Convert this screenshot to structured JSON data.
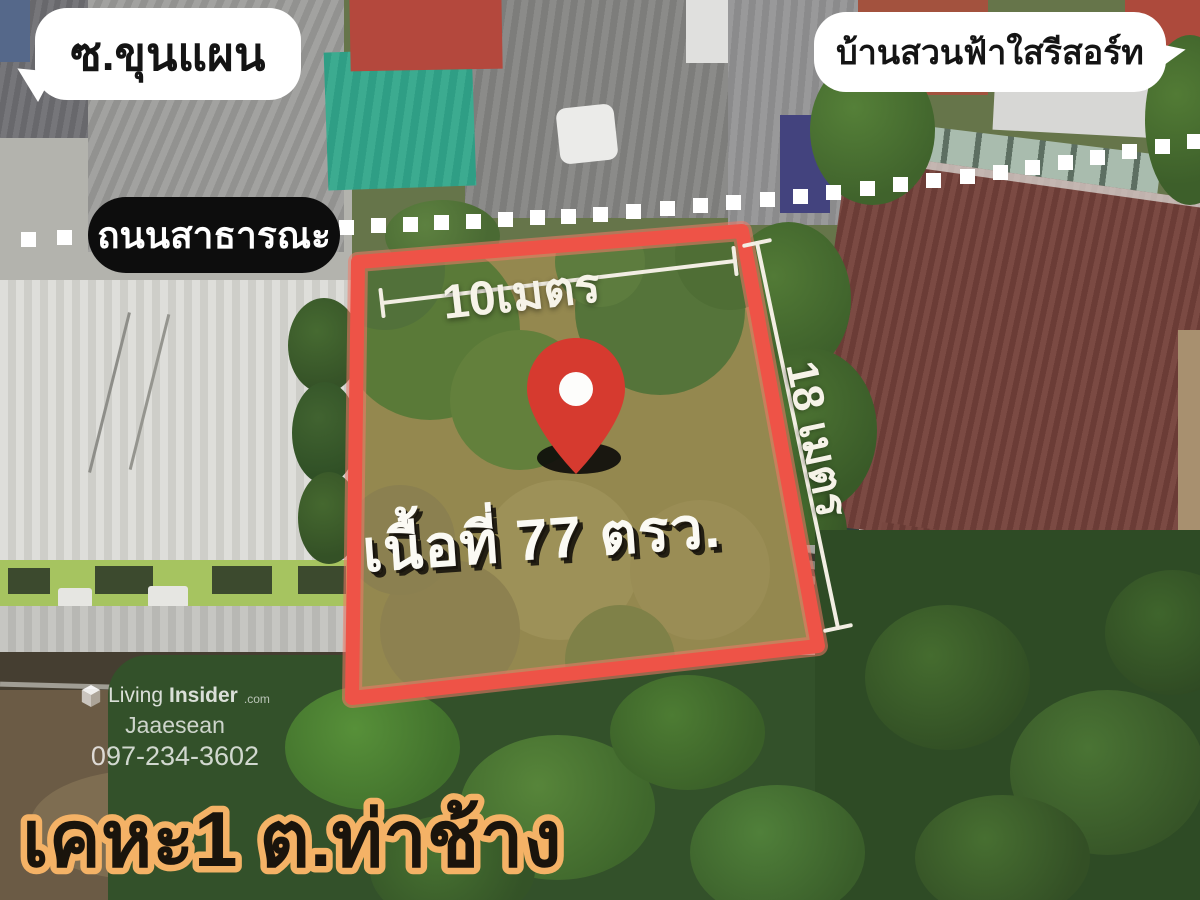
{
  "labels": {
    "soi": "ซ.ขุนแผน",
    "resort": "บ้านสวนฟ้าใสรีสอร์ท",
    "road": "ถนนสาธารณะ",
    "width_m": "10เมตร",
    "depth_m": "18 เมตร",
    "area": "เนื้อที่ 77 ตรว.",
    "location": "เคหะ1 ต.ท่าช้าง"
  },
  "watermark": {
    "brand_living": "Living",
    "brand_insider": "Insider",
    "brand_tld": ".com",
    "agent": "Jaaesean",
    "phone": "097-234-3602"
  },
  "icons": {
    "pin": "map-pin-icon",
    "logo": "livinginsider-cube-icon"
  },
  "colors": {
    "plot_outline": "#ee5347",
    "plot_ground": "#94884f",
    "pin_red": "#d63a2f",
    "bubble_bg": "#ffffff",
    "bubble_text": "#141414",
    "pill_bg": "#0d0d0d",
    "pill_text": "#ffffff",
    "measure_line": "#f2eee3",
    "measure_text": "#f6f3e8",
    "area_text": "#fbfaf4",
    "dotted_line": "#ffffff",
    "location_fill": "#1a140c",
    "location_stroke": "#f4b266"
  }
}
